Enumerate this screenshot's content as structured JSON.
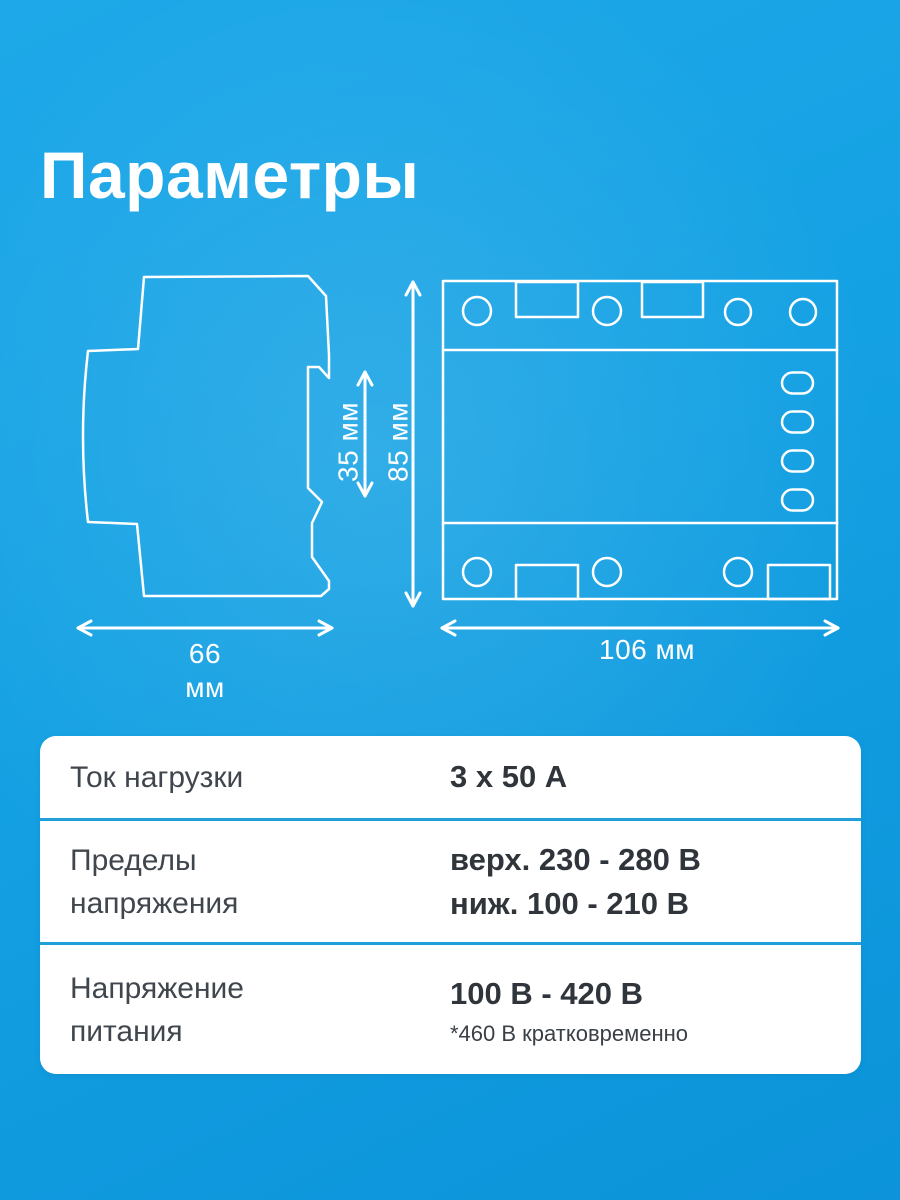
{
  "title": "Параметры",
  "diagram": {
    "side_width_value": "66",
    "side_width_unit": "мм",
    "rail_height_label": "35 мм",
    "front_height_label": "85 мм",
    "front_width_label": "106 мм"
  },
  "specs": {
    "row1": {
      "label_line1": "Ток нагрузки",
      "value1": "3 x 50 А"
    },
    "row2": {
      "label_line1": "Пределы",
      "label_line2": "напряжения",
      "value1": "верх. 230 - 280 В",
      "value2": "ниж. 100 - 210 В"
    },
    "row3": {
      "label_line1": "Напряжение",
      "label_line2": "питания",
      "value1": "100 В - 420 В",
      "note": "*460 В кратковременно"
    }
  },
  "colors": {
    "background_blue": "#14A1E3",
    "divider_blue": "#219FD8",
    "drawing_line": "#FFFFFF",
    "label_text": "#40464D",
    "value_text": "#2F353B"
  }
}
